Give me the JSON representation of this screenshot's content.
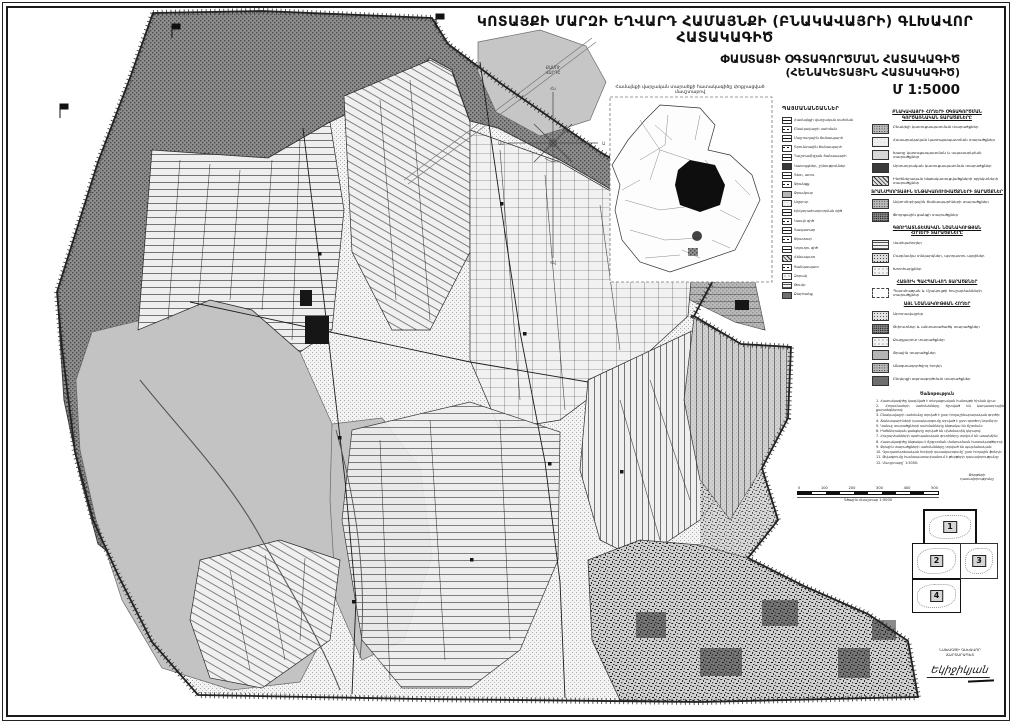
{
  "page": {
    "title": "ԿՈՏԱՅՔԻ ՄԱՐԶԻ ԵՂՎԱՐԴ ՀԱՄԱՅՆՔԻ (ԲՆԱԿԱՎԱՅՐԻ) ԳԼԽԱՎՈՐ ՀԱՏԱԿԱԳԻԾ",
    "subtitle_line1": "ՓԱՍՏԱՑԻ ՕԳՏԱԳՈՐԾՄԱՆ ՀԱՏԱԿԱԳԻԾ",
    "subtitle_line2": "(ՀԵՆԱԿԵՏԱՅԻՆ ՀԱՏԱԿԱԳԻԾ)",
    "scale_label": "Մ 1:5000"
  },
  "compass": {
    "label_line1": "ՔԱՄՈՒ",
    "label_line2": "ՎԱՐԴԸ",
    "tips": [
      "Հս",
      "Ա",
      "Հվ",
      "Ամ"
    ]
  },
  "inset": {
    "caption": "Համայնքի վարչական տարածքի հատակագիծը փոքրացված մասշտաբով"
  },
  "legend": {
    "mini_heading": "ՊԱՅՄԱՆԱՆՇԱՆՆԵՐ",
    "mini_items": [
      {
        "swatch": "sw-line-solid",
        "label": "Համայնքի վարչական սահման"
      },
      {
        "swatch": "sw-line-dash",
        "label": "Բնակավայրի սահման"
      },
      {
        "swatch": "sw-line-solid",
        "label": "Մայրուղային ճանապարհ"
      },
      {
        "swatch": "sw-line-dash",
        "label": "Գրունտային ճանապարհ"
      },
      {
        "swatch": "sw-line-solid",
        "label": "Դաշտամիջյան ճանապարհ"
      },
      {
        "swatch": "sw-dark",
        "label": "Կառույցներ, շինություններ"
      },
      {
        "swatch": "sw-line-solid",
        "label": "Գետ, առու"
      },
      {
        "swatch": "sw-line-dash",
        "label": "Ջրանցք"
      },
      {
        "swatch": "sw-gray",
        "label": "Ջրամբար"
      },
      {
        "swatch": "sw-dots-light",
        "label": "Աղբյուր"
      },
      {
        "swatch": "sw-line-solid",
        "label": "Էլեկտրահաղորդման գիծ"
      },
      {
        "swatch": "sw-line-dash",
        "label": "Կապի գիծ"
      },
      {
        "swatch": "sw-line-solid",
        "label": "Գազատար"
      },
      {
        "swatch": "sw-line-dash",
        "label": "Ջրատար"
      },
      {
        "swatch": "sw-line-solid",
        "label": "Կոյուղու գիծ"
      },
      {
        "swatch": "sw-hatch",
        "label": "Հենապատ"
      },
      {
        "swatch": "sw-line-dash",
        "label": "Ցանկապատ"
      },
      {
        "swatch": "sw-dots-sparse",
        "label": "Ձորակ"
      },
      {
        "swatch": "sw-stripes",
        "label": "Թումբ"
      },
      {
        "swatch": "sw-dark-gray",
        "label": "Քարհանք"
      }
    ],
    "sections": [
      {
        "header_lines": [
          "ԲՆԱԿԱՎԱՅՐԻ ՀՈՂԵՐԻ ՕԳՏԱԳՈՐԾՄԱՆ",
          "ԳՈՐԾԱՌՆԱԿԱՆ ՏԱՐԱԾՔՆԵՐԸ"
        ],
        "items": [
          {
            "swatch": "sw-speckle-med",
            "label": "Բնակելի կառուցապատման տարածքներ"
          },
          {
            "swatch": "sw-dots-light",
            "label": "Հասարակական կառուցապատման տարածքներ"
          },
          {
            "swatch": "sw-gray-light",
            "label": "Խառը կառուցապատման և սպասարկման տարածքներ"
          },
          {
            "swatch": "sw-dark",
            "label": "Արտադրական կառուցապատման տարածքներ"
          },
          {
            "swatch": "sw-hatch",
            "label": "Ինժեներական ենթակառուցվածքների օբյեկտների տարածքներ"
          }
        ]
      },
      {
        "header_lines": [
          "ՏՐԱՆՍՊՈՐՏԱՅԻՆ ԵՆԹԱԿԱՌՈՒՑՎԱԾՔՆԵՐԻ ՏԱՐԱԾՔՆԵՐ"
        ],
        "items": [
          {
            "swatch": "sw-speckle-med",
            "label": "Ավտոմոբիլային ճանապարհների տարածքներ"
          },
          {
            "swatch": "sw-speckle-dark",
            "label": "Փողոցային ցանցի տարածքներ"
          }
        ]
      },
      {
        "header_lines": [
          "ԳՅՈՒՂԱՏՆՏԵՍԱԿԱՆ ՆՇԱՆԱԿՈՒԹՅԱՆ",
          "ՀՈՂԵՐԻ ՏԱՐԱԾՔՆԵՐԸ"
        ],
        "items": [
          {
            "swatch": "sw-stripes",
            "label": "Վարելահողեր"
          },
          {
            "swatch": "sw-dots-med",
            "label": "Բազմամյա տնկարկներ, պտղատու այգիներ"
          },
          {
            "swatch": "sw-dots-sparse",
            "label": "Խոտհարքներ"
          }
        ]
      },
      {
        "header_lines": [
          "ՀԱՏՈՒԿ ՊԱՀՊԱՆՎՈՂ ՏԱՐԱԾՔՆԵՐ"
        ],
        "items": [
          {
            "swatch": "sw-dashed",
            "label": "Պատմության և մշակույթի հուշարձանների տարածքներ"
          }
        ]
      },
      {
        "header_lines": [
          "ԱՅԼ ՆՇԱՆԱԿՈՒԹՅԱՆ ՀՈՂԵՐ"
        ],
        "items": [
          {
            "swatch": "sw-speckle-light",
            "label": "Արոտավայրեր"
          },
          {
            "swatch": "sw-speckle-dark",
            "label": "Թփուտներ և անտառածածկ տարածքներ"
          },
          {
            "swatch": "sw-dots-sparse",
            "label": "Քարքարոտ տարածքներ"
          },
          {
            "swatch": "sw-gray",
            "label": "Ջրային տարածքներ"
          },
          {
            "swatch": "sw-speckle-med",
            "label": "Անօգտագործվող հողեր"
          },
          {
            "swatch": "sw-dark-gray",
            "label": "Ընդերքի օգտագործման տարածքներ"
          }
        ]
      }
    ]
  },
  "notes": {
    "title": "Ծանոթություն",
    "lines": [
      "1. Հատակագիծը կազմված է տեղագրական հանույթի հիման վրա։",
      "2. Հողամասերի սահմանները ճշտված են կադաստրային քարտեզներով։",
      "3. Բնակավայրի սահմանը տրված է ըստ հողաշինարարական գործի։",
      "4. Ճանապարհների դասակարգումը տրված է ըստ գործող նորմերի։",
      "5. Կանաչ տարածքների սահմանները ենթակա են ճշտման։",
      "6. Ինժեներական ցանցերը տրված են սխեմատիկ կերպով։",
      "7. Հուշարձանների պահպանական գոտիները տրվում են առանձին։",
      "8. Հատակագիծը ենթակա է ճշգրտման մանրամասն հատակագծերով։",
      "9. Ջրային տարածքների սահմանները տրված են պայմանական։",
      "10. Գյուղատնտեսական հողերի դասակարգումը՝ ըստ հողային ֆոնդի։",
      "11. Թվագրումը համապատասխանում է թերթերի դասավորությանը։",
      "12. Մասշտաբը՝ 1:5000։"
    ]
  },
  "scalebar": {
    "ticks": [
      "0",
      "100",
      "200",
      "300",
      "400",
      "500"
    ],
    "caption": "Գծային մասշտաբ 1:5000"
  },
  "sheet_index": {
    "caption_line1": "Թերթերի",
    "caption_line2": "դասավորությունը",
    "sheets": [
      "1",
      "2",
      "3",
      "4"
    ]
  },
  "signature": {
    "org_line1": "ՆԱԽԱԳԾԻ ԳԼԽԱՎՈՐ",
    "org_line2": "ՃԱՐՏԱՐԱՊԵՏ",
    "name": "Եկիջիկյան"
  },
  "colors": {
    "paper": "#ffffff",
    "ink": "#111111",
    "dark_stipple": "#6f6f6f",
    "gray_area": "#c3c3c3",
    "light_field": "#efefef"
  }
}
